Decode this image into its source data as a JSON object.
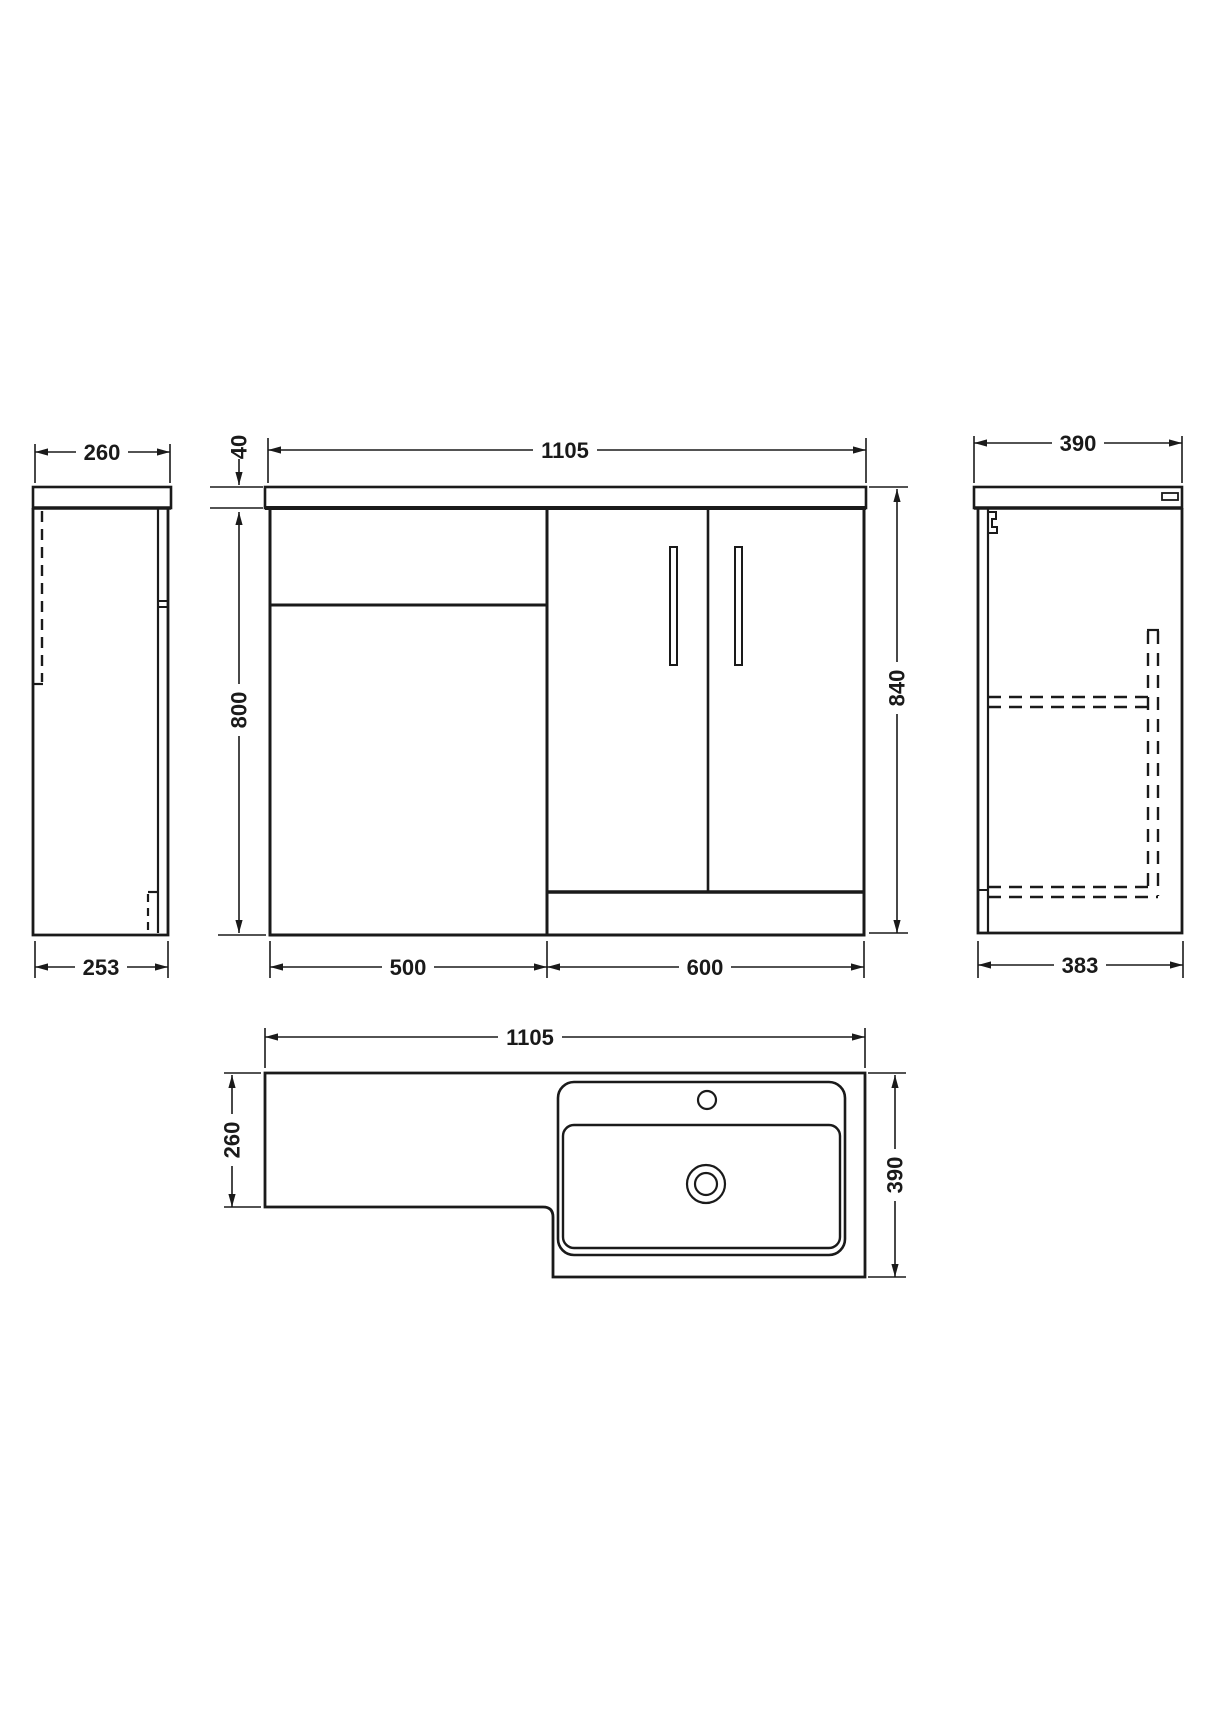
{
  "drawing": {
    "description": "Technical dimension drawing of L-shaped bathroom vanity and WC combination unit, four orthographic views",
    "background_color": "#ffffff",
    "line_color": "#1a1a1a",
    "units": "mm",
    "views": {
      "left_side": {
        "name": "left-side-elevation",
        "dim_top": "260",
        "dim_bottom": "253"
      },
      "front": {
        "name": "front-elevation",
        "dim_width": "1105",
        "dim_worktop": "40",
        "dim_height": "800",
        "dim_total_height": "840",
        "dim_left_width": "500",
        "dim_right_width": "600"
      },
      "right_side": {
        "name": "right-side-elevation",
        "dim_top": "390",
        "dim_bottom": "383"
      },
      "plan": {
        "name": "plan-view",
        "dim_width": "1105",
        "dim_left_depth": "260",
        "dim_right_depth": "390"
      }
    }
  }
}
